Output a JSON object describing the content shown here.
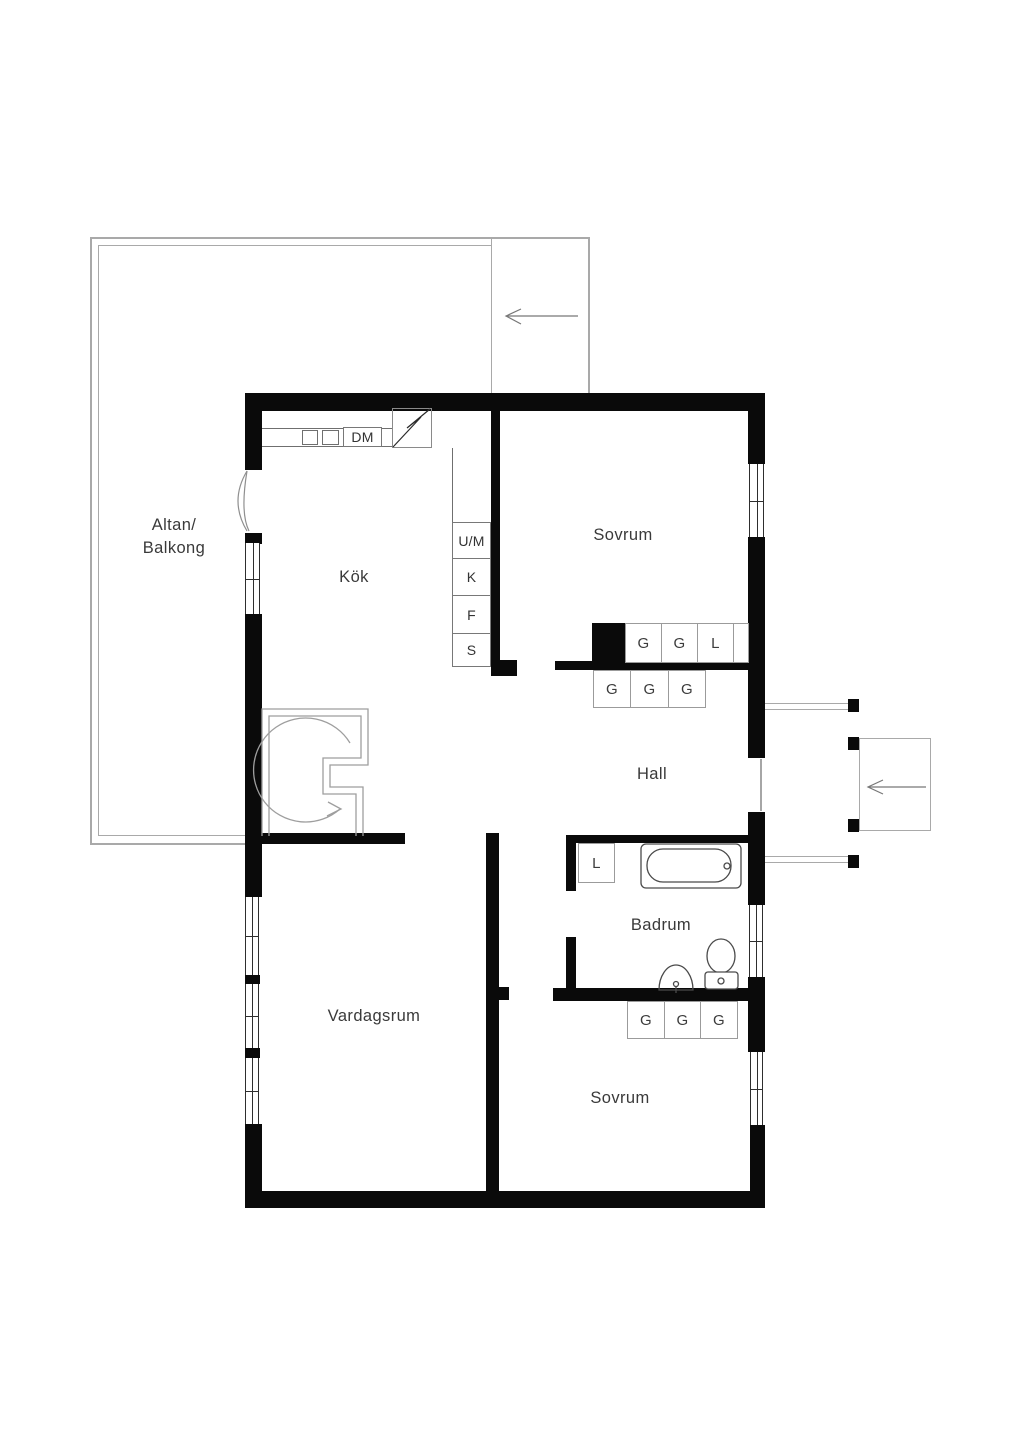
{
  "plan": {
    "rooms": {
      "terrace_line1": "Altan/",
      "terrace_line2": "Balkong",
      "kitchen": "Kök",
      "bedroom_top": "Sovrum",
      "hall": "Hall",
      "bathroom": "Badrum",
      "living_room": "Vardagsrum",
      "bedroom_bottom": "Sovrum"
    },
    "kitchen": {
      "dishwasher_label": "DM",
      "appliances": [
        "U/M",
        "K",
        "F",
        "S"
      ]
    },
    "wardrobes": {
      "bedroom_top": [
        "G",
        "G",
        "L"
      ],
      "hall": [
        "G",
        "G",
        "G"
      ],
      "bedroom_bottom": [
        "G",
        "G",
        "G"
      ],
      "bathroom_closet": "L"
    }
  },
  "colors": {
    "wall": "#0a0a0a",
    "terrace_line": "#a9a9a9",
    "fixture_line": "#4a4a4a",
    "box_border": "#9b9b9b",
    "text": "#3a3a3a",
    "arrow": "#777777"
  }
}
